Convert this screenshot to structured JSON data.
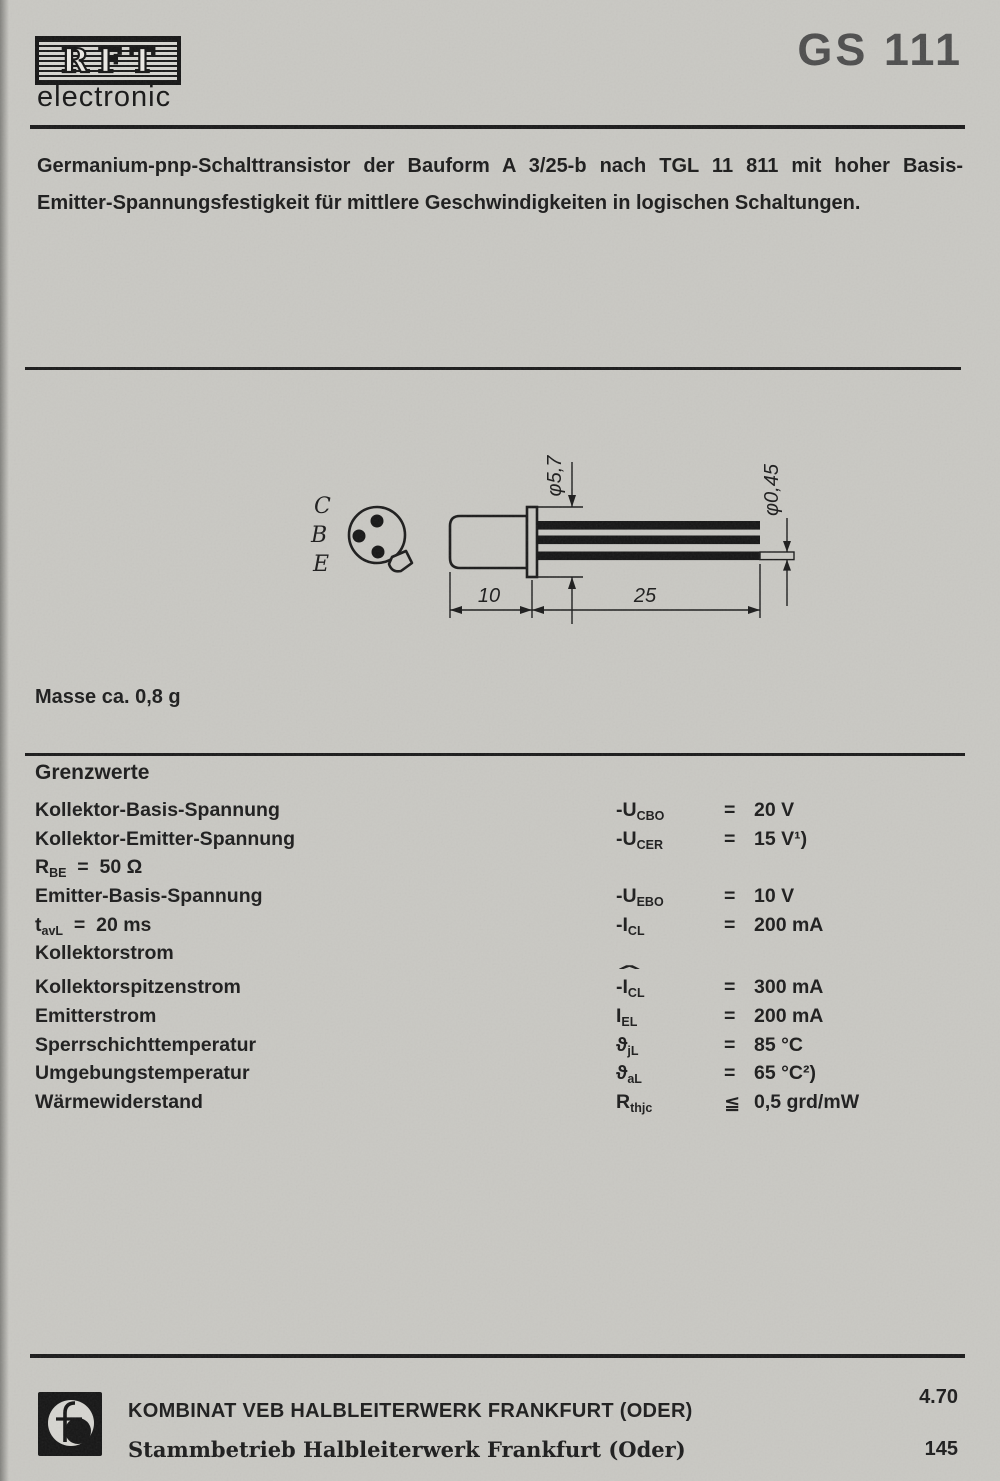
{
  "colors": {
    "paper": "#c9c8c3",
    "ink": "#1d1d1d",
    "part_number_gray": "#4e4e4e"
  },
  "header": {
    "brand": "RFT",
    "brand_sub": "electronic",
    "part_number": "GS 111"
  },
  "description": {
    "line1": "Germanium-pnp-Schalttransistor der Bauform A 3/25-b nach TGL 11 811 mit hoher Basis-",
    "line2": "Emitter-Spannungsfestigkeit für mittlere Geschwindigkeiten in logischen Schaltungen."
  },
  "drawing": {
    "pins": [
      "C",
      "B",
      "E"
    ],
    "dims": {
      "body_dia": "φ5,7",
      "lead_dia": "φ0,45",
      "body_len": "10",
      "lead_len": "25"
    }
  },
  "mass_note": "Masse ca. 0,8 g",
  "limits": {
    "title": "Grenzwerte",
    "rows": [
      {
        "label_base": "Kollektor-Basis-Spannung",
        "sym_base": "-U",
        "sym_sub": "CBO",
        "eq": "=",
        "value": "20 V"
      },
      {
        "label_base": "Kollektor-Emitter-Spannung",
        "sym_base": "-U",
        "sym_sub": "CER",
        "eq": "=",
        "value": "15 V¹)"
      },
      {
        "label_base": "R",
        "label_sub": "BE",
        "label_rest": "  =  50 Ω"
      },
      {
        "label_base": "Emitter-Basis-Spannung",
        "sym_base": "-U",
        "sym_sub": "EBO",
        "eq": "=",
        "value": "10 V"
      },
      {
        "label_base": "t",
        "label_sub": "avL",
        "label_rest": "  =  20 ms",
        "sym_base": "-I",
        "sym_sub": "CL",
        "eq": "=",
        "value": "200 mA"
      },
      {
        "label_base": "Kollektorstrom"
      },
      {
        "label_base": "Kollektorspitzenstrom",
        "sym_hat": "ˆ",
        "sym_base": "-I",
        "sym_sub": "CL",
        "eq": "=",
        "value": "300 mA"
      },
      {
        "label_base": "Emitterstrom",
        "sym_base": "I",
        "sym_sub": "EL",
        "eq": "=",
        "value": "200 mA"
      },
      {
        "label_base": "Sperrschichttemperatur",
        "sym_base": "ϑ",
        "sym_sub": "jL",
        "eq": "=",
        "value": "85 °C"
      },
      {
        "label_base": "Umgebungstemperatur",
        "sym_base": "ϑ",
        "sym_sub": "aL",
        "eq": "=",
        "value": "65 °C²)"
      },
      {
        "label_base": "Wärmewiderstand",
        "sym_base": "R",
        "sym_sub": "thjc",
        "eq": "≦",
        "value": "0,5 grd/mW"
      }
    ]
  },
  "footer": {
    "company_line1": "KOMBINAT VEB HALBLEITERWERK FRANKFURT (ODER)",
    "company_line2": "Stammbetrieb Halbleiterwerk Frankfurt (Oder)",
    "date_code": "4.70",
    "page_number": "145"
  }
}
